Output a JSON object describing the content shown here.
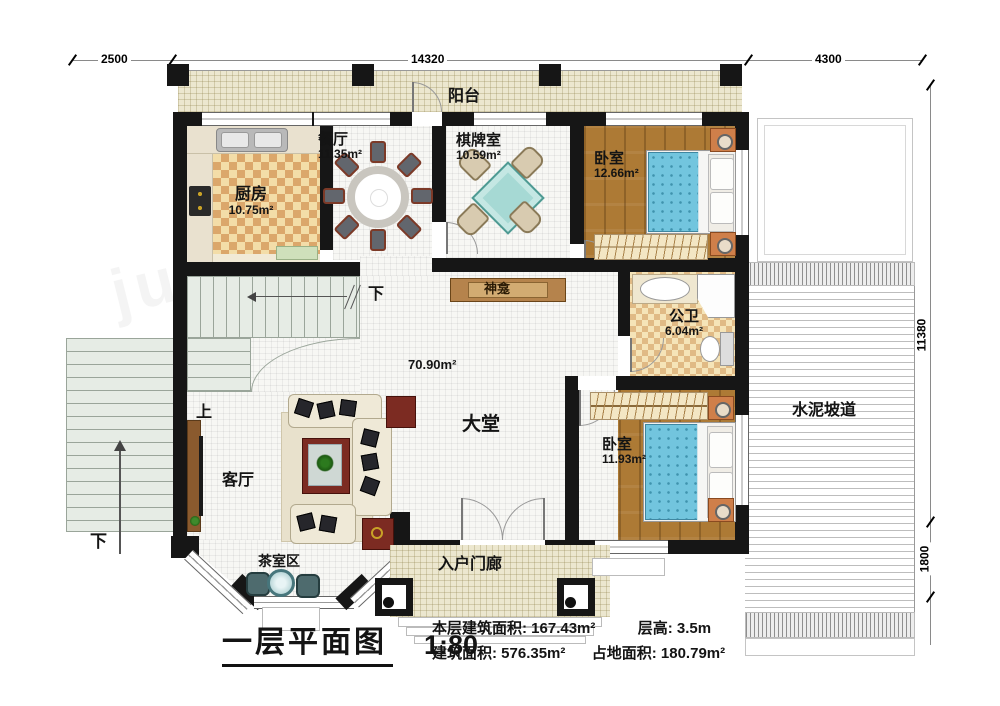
{
  "title": {
    "text": "一层平面图",
    "scale": "1:80"
  },
  "summary": {
    "floor_area_label": "本层建筑面积:",
    "floor_area_value": "167.43m²",
    "story_height_label": "层高:",
    "story_height_value": "3.5m",
    "total_area_label": "建筑面积:",
    "total_area_value": "576.35m²",
    "footprint_label": "占地面积:",
    "footprint_value": "180.79m²"
  },
  "dimensions": {
    "top_left": "2500",
    "top_middle": "14320",
    "top_right": "4300",
    "right_upper": "11380",
    "right_lower": "1800"
  },
  "rooms": {
    "balcony": {
      "label": "阳台"
    },
    "kitchen": {
      "label": "厨房",
      "area": "10.75m²"
    },
    "dining": {
      "label": "餐厅",
      "area": "11.35m²"
    },
    "chess_room": {
      "label": "棋牌室",
      "area": "10.59m²"
    },
    "bedroom_top": {
      "label": "卧室",
      "area": "12.66m²"
    },
    "shrine": {
      "label": "神龛"
    },
    "bathroom": {
      "label": "公卫",
      "area": "6.04m²"
    },
    "bedroom_bottom": {
      "label": "卧室",
      "area": "11.93m²"
    },
    "hall": {
      "label": "大堂",
      "area": "70.90m²"
    },
    "living_room": {
      "label": "客厅"
    },
    "tea_area": {
      "label": "茶室区"
    },
    "entry_porch": {
      "label": "入户门廊"
    },
    "ramp": {
      "label": "水泥坡道"
    }
  },
  "stairs": {
    "up": "上",
    "down": "下",
    "exterior_down": "下"
  },
  "watermark": "juni",
  "colors": {
    "wall": "#161616",
    "wood": "#ad7a35",
    "mattress": "#72c5de",
    "balcony_floor": "#ece7cf",
    "kitchen_tile": "#dba76b",
    "stair": "#e6ece5",
    "accent_table": "#7c2b22"
  }
}
